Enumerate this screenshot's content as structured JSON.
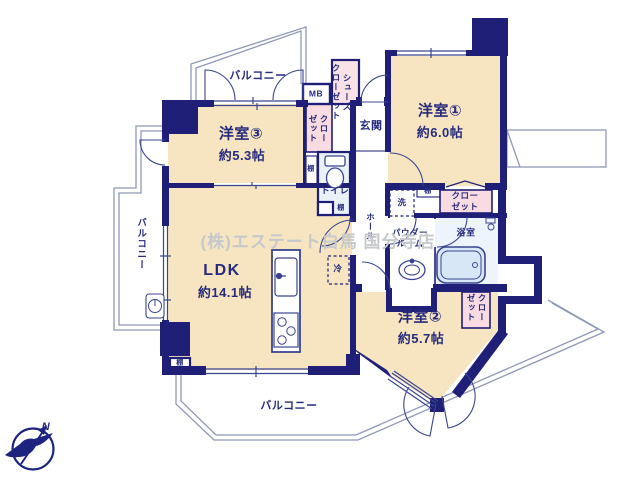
{
  "watermark": "(株)エステート白馬 国分寺店",
  "labels": {
    "balcony": "バルコニー",
    "mb": "MB",
    "shoes_closet": "シューズ\nクローゼット",
    "closet_wrap": "クロー\nゼット",
    "entrance": "玄関",
    "hall": "ホール",
    "toilet": "トイレ",
    "bath": "浴室",
    "powder": "パウダー\nルーム",
    "washer": "洗",
    "fridge": "冷",
    "shelf": "棚",
    "north": "N"
  },
  "rooms": {
    "room1": {
      "name": "洋室①",
      "size": "約6.0帖"
    },
    "room2": {
      "name": "洋室②",
      "size": "約5.7帖"
    },
    "room3": {
      "name": "洋室③",
      "size": "約5.3帖"
    },
    "ldk": {
      "name": "LDK",
      "size": "約14.1帖"
    }
  },
  "colors": {
    "wall": "#1f1f78",
    "room_fill": "#f6e5c0",
    "closet_fill": "#f9dce1",
    "wet_fill": "#e9f1f9",
    "fixture_fill": "#d7e7f5",
    "outline": "#9098b8",
    "text": "#262b7d",
    "watermark": "#c6c9cc"
  }
}
